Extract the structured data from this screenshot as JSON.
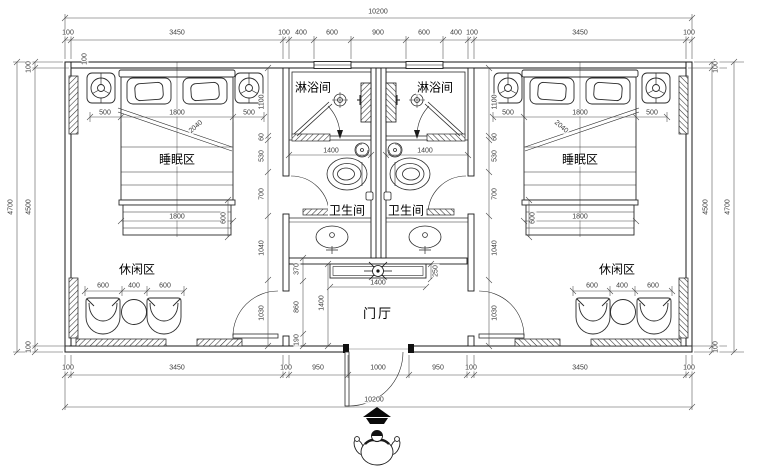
{
  "title": "twin-room floor plan",
  "colors": {
    "line": "#1a1a1a",
    "dim_text": "#3c3c3c",
    "fill": "#ffffff"
  },
  "labels": {
    "shower_left": "淋浴间",
    "shower_right": "淋浴间",
    "sleep_left": "睡眠区",
    "sleep_right": "睡眠区",
    "wc_left": "卫生间",
    "wc_right": "卫生间",
    "leisure_left": "休闲区",
    "leisure_right": "休闲区",
    "hall": "门厅"
  },
  "dims": {
    "top_total": "10200",
    "bottom_total": "10200",
    "top_row": [
      "100",
      "3450",
      "100",
      "400",
      "600",
      "900",
      "600",
      "400",
      "100",
      "3450",
      "100"
    ],
    "bottom_row": [
      "100",
      "3450",
      "100",
      "950",
      "1000",
      "950",
      "100",
      "3450",
      "100"
    ],
    "left_outer": "4700",
    "left_inner": "4500",
    "right_inner": "4500",
    "right_outer": "4700",
    "wall100_left_top": "100",
    "wall100_left_bottom": "100",
    "wall100_right_top": "100",
    "wall100_right_bottom": "100",
    "wall100_corner": "100",
    "bed_row_left": [
      "500",
      "1800",
      "500"
    ],
    "bed_row_right": [
      "500",
      "1800",
      "500"
    ],
    "bed_bottom_left": "1800",
    "bed_bottom_right": "1800",
    "bench_left": "600",
    "bench_right": "600",
    "bed_diag_left": "2040",
    "bed_diag_right": "2040",
    "leisure_row_left": [
      "600",
      "400",
      "600"
    ],
    "leisure_row_right": [
      "600",
      "400",
      "600"
    ],
    "bath_width_left": "1400",
    "bath_width_right": "1400",
    "hall_chain": [
      "370",
      "860",
      "190"
    ],
    "hall_height": "1400",
    "console_width": "1400",
    "console_depth": "250",
    "room_chain_left": [
      "1100",
      "60",
      "530",
      "700",
      "1040",
      "1030"
    ],
    "room_chain_right": [
      "1100",
      "60",
      "530",
      "700",
      "1040",
      "1030"
    ]
  }
}
